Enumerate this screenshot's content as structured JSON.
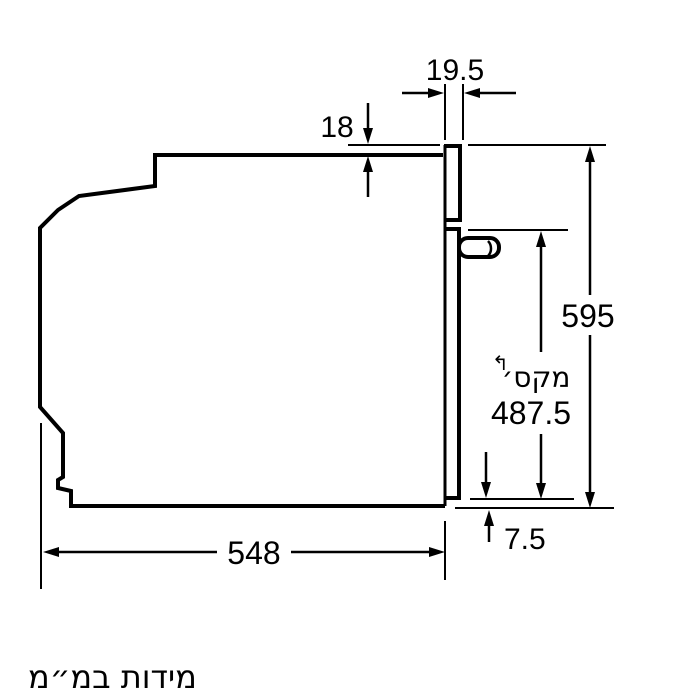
{
  "drawing": {
    "caption": "מידות במ״מ",
    "dims": {
      "frame_width": "19.5",
      "top_overhang": "18",
      "height": "595",
      "max_label": "מקס׳",
      "max_value": "487.5",
      "bottom_gap": "7.5",
      "depth": "548",
      "ref_arrow": "↰"
    },
    "colors": {
      "line": "#000000",
      "background": "#ffffff"
    }
  }
}
